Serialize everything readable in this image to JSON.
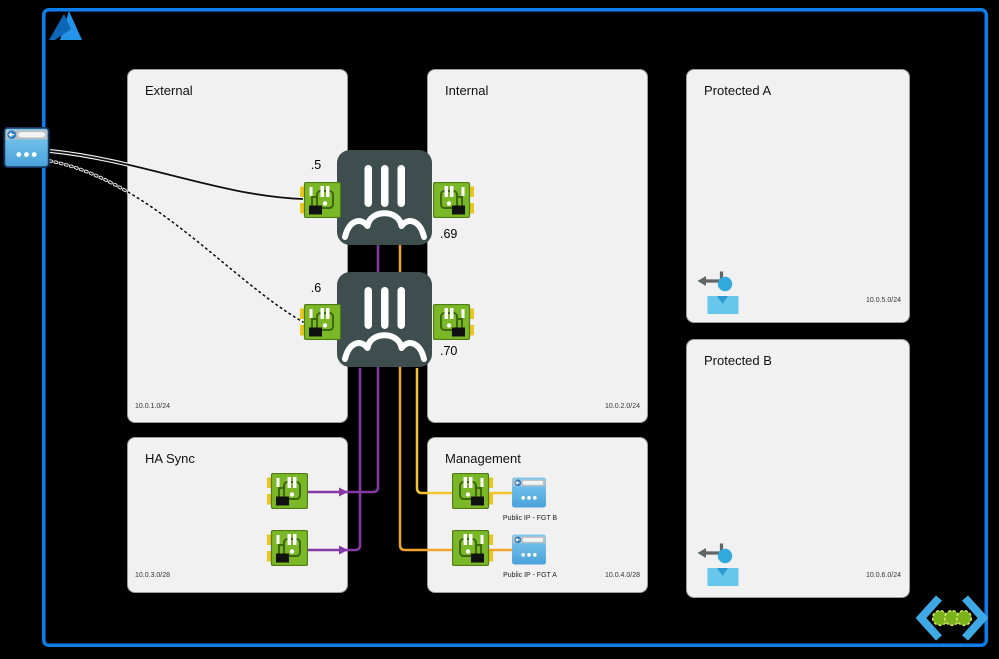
{
  "diagram": {
    "description": "FortiGate HA pair on Azure network diagram",
    "zones": {
      "external": {
        "title": "External",
        "subnet": "10.0.1.0/24"
      },
      "internal": {
        "title": "Internal",
        "subnet": "10.0.2.0/24"
      },
      "ha_sync": {
        "title": "HA Sync",
        "subnet": "10.0.3.0/28"
      },
      "management": {
        "title": "Management",
        "subnet": "10.0.4.0/28"
      },
      "protected_a": {
        "title": "Protected A",
        "subnet": "10.0.5.0/24"
      },
      "protected_b": {
        "title": "Protected B",
        "subnet": "10.0.6.0/24"
      }
    },
    "firewalls": {
      "fgt_a": {
        "external_ip": ".5",
        "internal_ip": ".69"
      },
      "fgt_b": {
        "external_ip": ".6",
        "internal_ip": ".70"
      }
    },
    "management_ips": {
      "fgt_b_label": "Public IP - FGT B",
      "fgt_a_label": "Public IP - FGT A"
    },
    "icons": {
      "azure_logo": "azure-a-triangle",
      "edge_public_ip": "public-ip-browser-window",
      "fortigate": "fortigate-appliance",
      "nic": "network-interface-card",
      "public_ip": "public-ip-browser-window",
      "protected_workload": "user-with-return-arrow",
      "load_balancer": "chevrons-with-three-dots"
    },
    "colors": {
      "frame_blue": "#0d7fe8",
      "zone_fill": "#f1f1f1",
      "fortigate_body": "#3e4e4e",
      "nic_green": "#7ab827",
      "nic_tab_yellow": "#e9c51f",
      "ha_sync_line_purple": "#8639a6",
      "mgmt_line_orange": "#f0a42b",
      "mgmt_line_yellow": "#f0c52e",
      "public_ip_blue": "#4aa2da",
      "person_blue": "#66c7eb",
      "lb_chevron_blue": "#3fa9e6",
      "lb_dot_green": "#7ab31c",
      "external_link_black": "#111111"
    }
  }
}
